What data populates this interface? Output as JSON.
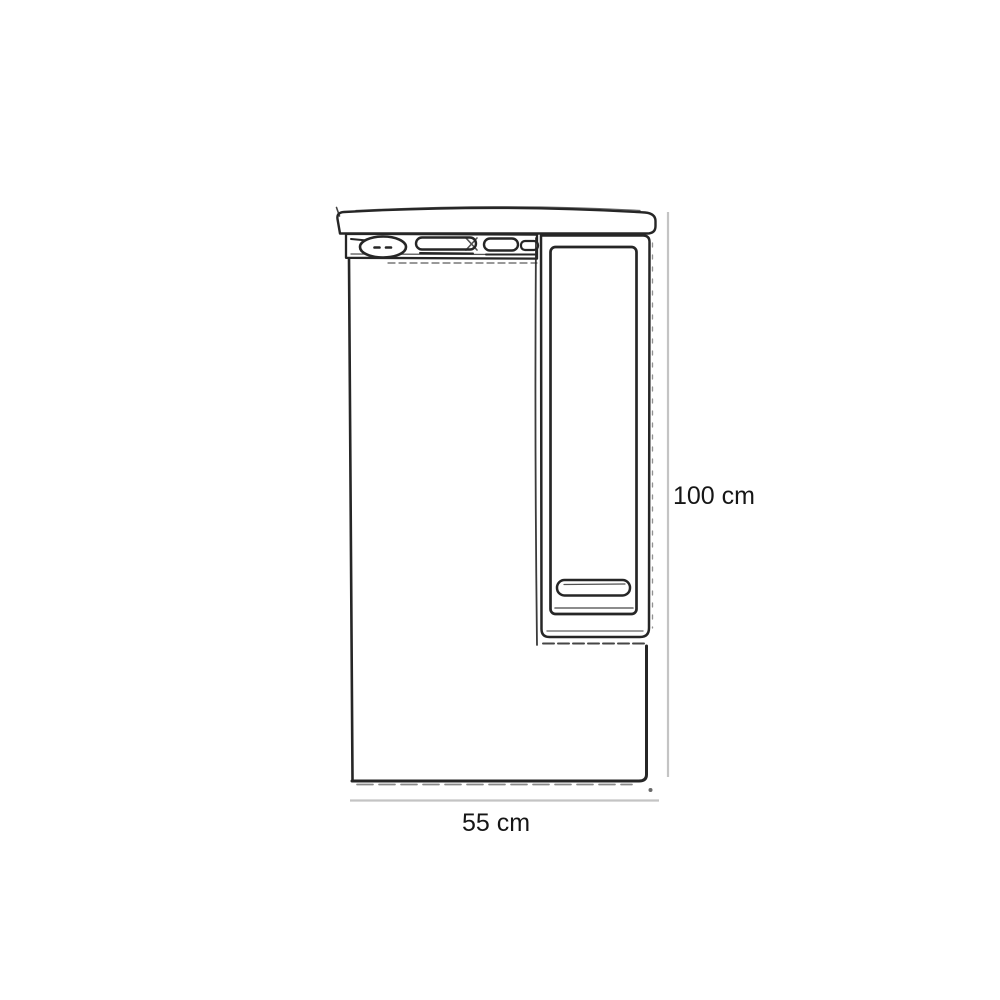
{
  "diagram": {
    "dimension_labels": {
      "height": "100 cm",
      "width": "55 cm"
    },
    "colors": {
      "ink": "#262626",
      "dimension_line": "#c4c4c4",
      "label_text": "#161616",
      "background": "#ffffff"
    }
  }
}
